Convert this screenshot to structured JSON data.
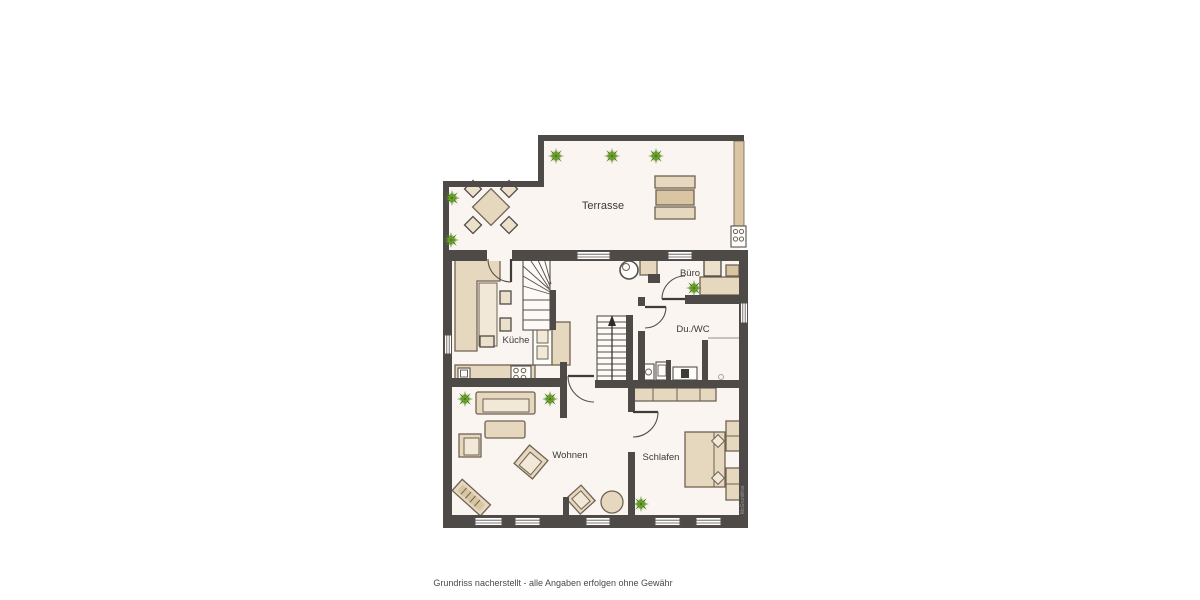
{
  "caption": "Grundriss nacherstellt - alle Angaben erfolgen ohne Gewähr",
  "watermark": "McGrundriss",
  "rooms": {
    "terrasse": {
      "label": "Terrasse"
    },
    "kueche": {
      "label": "Küche"
    },
    "buero": {
      "label": "Büro"
    },
    "du_wc": {
      "label": "Du./WC"
    },
    "wohnen": {
      "label": "Wohnen"
    },
    "schlafen": {
      "label": "Schlafen"
    }
  },
  "icons": {
    "plant-icon": "8-point green star",
    "hob-icon": "four burner circles",
    "grill-icon": "square with four circles",
    "round-stove-icon": "concentric circles",
    "toilet-icon": "rect with dark seat mark",
    "shower-drain-icon": "small circle",
    "stair-arrow-icon": "upward arrow",
    "window-icon": "white slot with mullion lines"
  },
  "colors": {
    "wall": "#4e4a47",
    "floor": "#faf5f0",
    "furn": "#e6d8bf",
    "furnDark": "#d9c5a2",
    "furnLight": "#f1e8d7",
    "chairFill": "#ece0cb",
    "outline": "#6f6252",
    "white": "#fdfdfc",
    "plantA": "#4a7d1c",
    "plantB": "#74a92f",
    "labelText": "#3a3a3a",
    "captionText": "#4a4a4a",
    "watermarkText": "#9c9c9c"
  }
}
